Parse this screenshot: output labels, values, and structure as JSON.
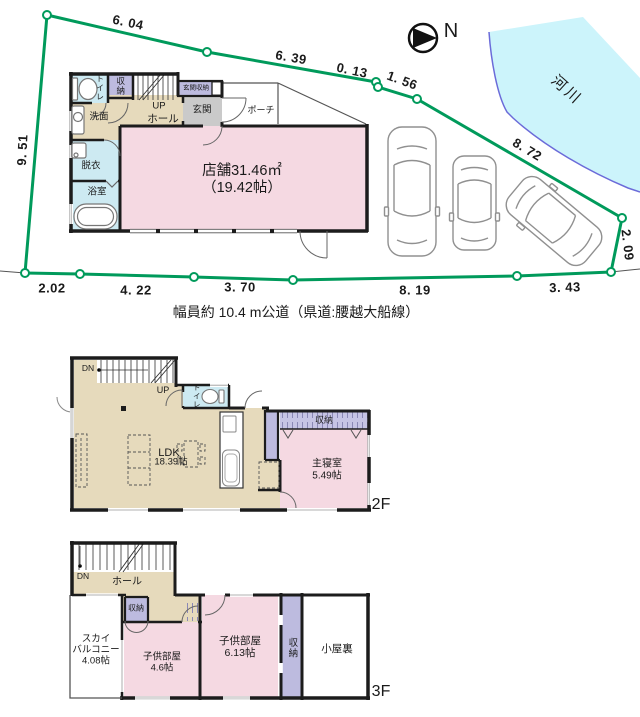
{
  "colors": {
    "boundary_green": "#009a5b",
    "river_fill": "#ccf4fb",
    "river_edge": "#6b6bd9",
    "room_pink": "#f5d9e2",
    "room_tan": "#e6dabc",
    "room_blue": "#cdeaf2",
    "room_lavender": "#bdbbdf",
    "entry_gray": "#cacaca",
    "wall_black": "#1c1c1c"
  },
  "site_plan": {
    "north_label": "N",
    "river_label": "河川",
    "road_label": "幅員約 10.4 m公道（県道:腰越大船線）",
    "measurements": {
      "top_1": "6. 04",
      "top_2": "6. 39",
      "top_3": "0. 13",
      "top_4": "1. 56",
      "northeast": "8. 72",
      "east": "2. 09",
      "west": "9. 51",
      "bottom_1": "2.02",
      "bottom_2": "4. 22",
      "bottom_3": "3. 70",
      "bottom_4": "8. 19",
      "bottom_5": "3. 43"
    }
  },
  "floor1": {
    "toilet": "トイレ",
    "closet": "収納",
    "entrance_closet": "玄関収納",
    "entrance": "玄関",
    "porch": "ポーチ",
    "stairs_up": "UP",
    "hall": "ホール",
    "washroom": "洗面",
    "dressing": "脱衣",
    "bathroom": "浴室",
    "shop_area": "店舗31.46㎡",
    "shop_tatami": "（19.42帖）"
  },
  "floor2": {
    "floor_label": "2F",
    "stairs_down": "DN",
    "stairs_up": "UP",
    "toilet": "トイレ",
    "ldk": "LDK",
    "ldk_size": "18.39帖",
    "closet": "収納",
    "master_bedroom": "主寝室",
    "master_bedroom_size": "5.49帖"
  },
  "floor3": {
    "floor_label": "3F",
    "stairs_down": "DN",
    "hall": "ホール",
    "closet_hall": "収納",
    "sky_balcony_1": "スカイ",
    "sky_balcony_2": "バルコニー",
    "sky_balcony_size": "4.08帖",
    "kids_room_1": "子供部屋",
    "kids_room_1_size": "4.6帖",
    "kids_room_2": "子供部屋",
    "kids_room_2_size": "6.13帖",
    "closet_tall": "収納",
    "attic": "小屋裏"
  }
}
